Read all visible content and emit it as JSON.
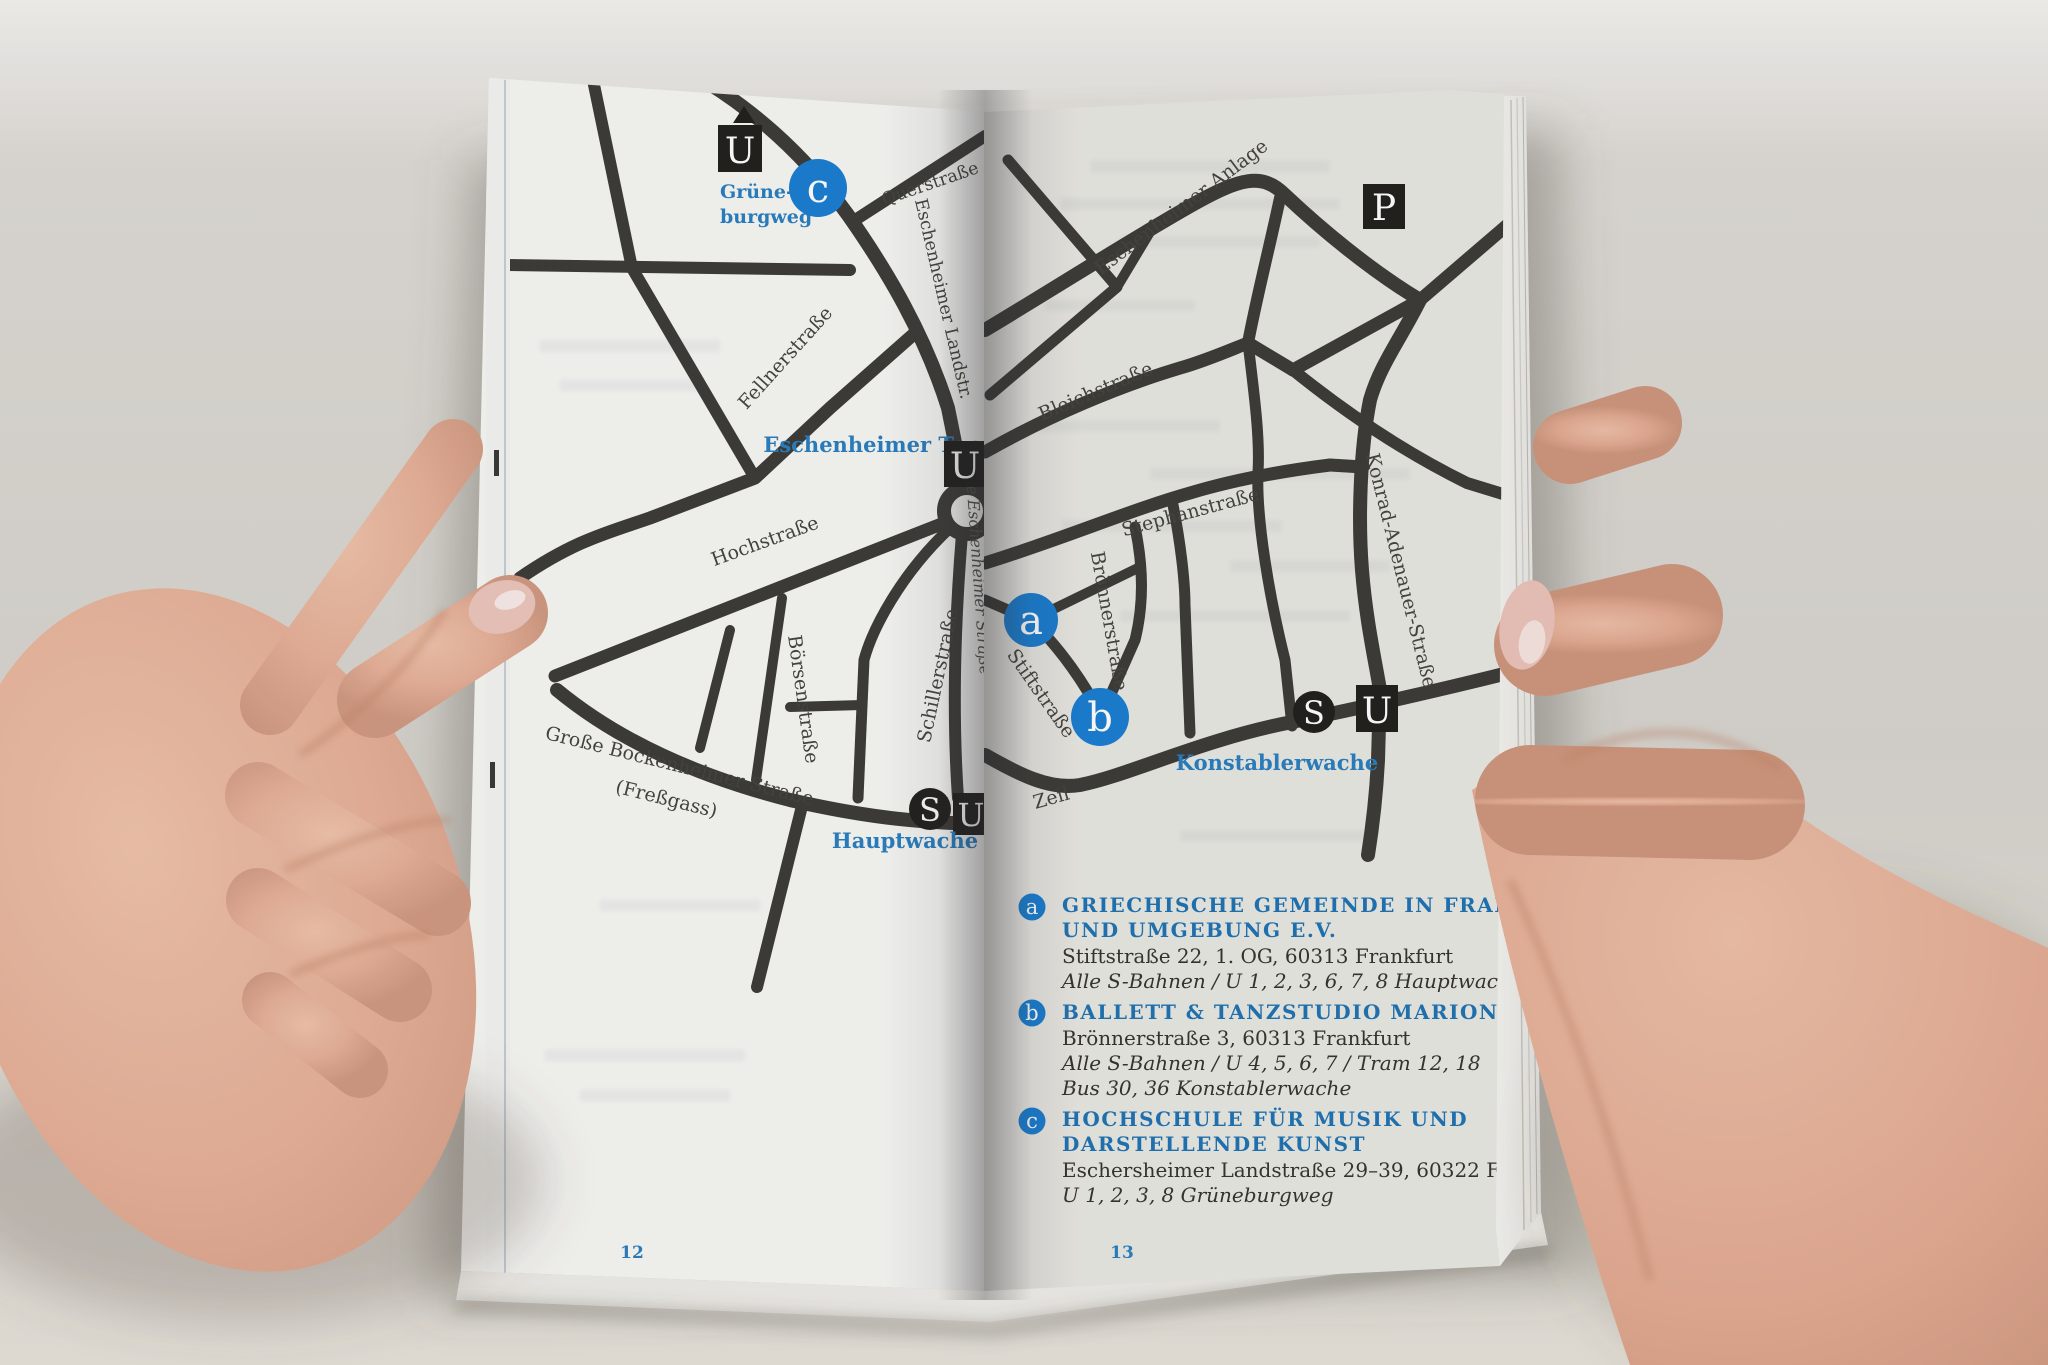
{
  "colors": {
    "marker_blue": "#1b7ed2",
    "label_blue": "#2a7fc1",
    "heading_blue": "#2173b4",
    "road_dark": "#3d3c38",
    "left_paper": "#f7f7f4",
    "right_paper": "#e9e8e3"
  },
  "left_page": {
    "page_number": "12",
    "station_grueneburgweg": {
      "symbol": "U",
      "label_line1": "Grüne-",
      "label_line2": "burgweg"
    },
    "marker_c": "c",
    "streets": {
      "querstrasse": "Querstraße",
      "eschenheimer_landstr": "Eschenheimer Landstr.",
      "fellnerstrasse": "Fellnerstraße",
      "hochstrasse": "Hochstraße",
      "boersenstrasse": "Börsenstraße",
      "schillerstrasse": "Schillerstraße",
      "grosse_bockenheimer_line1": "Große Bockenheimer Straße",
      "grosse_bockenheimer_line2": "(Freßgass)",
      "grosse_eschenheimer": "Große Eschenheimer Straße"
    },
    "stations": {
      "eschenheimer_tor": {
        "symbol": "U",
        "label": "Eschenheimer Tor"
      },
      "hauptwache": {
        "symbol_s": "S",
        "symbol_u": "U",
        "label": "Hauptwache"
      }
    }
  },
  "right_page": {
    "page_number": "13",
    "parking_symbol": "P",
    "marker_a": "a",
    "marker_b": "b",
    "streets": {
      "eschenheimer_anlage": "Eschenheimer Anlage",
      "bleichstrasse": "Bleichstraße",
      "stephanstrasse": "Stephanstraße",
      "broennerstrasse": "Brönnerstraße",
      "konrad_adenauer": "Konrad-Adenauer-Straße",
      "stiftstrasse": "Stiftstraße",
      "zeil": "Zeil"
    },
    "stations": {
      "konstablerwache": {
        "symbol_s": "S",
        "symbol_u": "U",
        "label": "Konstablerwache"
      }
    },
    "legend": [
      {
        "marker": "a",
        "title_line1": "GRIECHISCHE GEMEINDE IN FRANKFURT",
        "title_line2": "UND UMGEBUNG E.V.",
        "address": "Stiftstraße 22, 1. OG, 60313 Frankfurt",
        "transit_line1": "Alle S-Bahnen / U 1, 2, 3, 6, 7, 8 Hauptwache",
        "transit_line2": ""
      },
      {
        "marker": "b",
        "title_line1": "BALLETT & TANZSTUDIO MARION BALZER",
        "title_line2": "",
        "address": "Brönnerstraße 3, 60313 Frankfurt",
        "transit_line1": "Alle S-Bahnen / U 4, 5, 6, 7 / Tram 12, 18",
        "transit_line2": "Bus 30, 36 Konstablerwache"
      },
      {
        "marker": "c",
        "title_line1": "HOCHSCHULE FÜR MUSIK UND",
        "title_line2": "DARSTELLENDE KUNST",
        "address": "Eschersheimer Landstraße 29–39, 60322 Frankfurt",
        "transit_line1": "U 1, 2, 3, 8 Grüneburgweg",
        "transit_line2": ""
      }
    ]
  }
}
